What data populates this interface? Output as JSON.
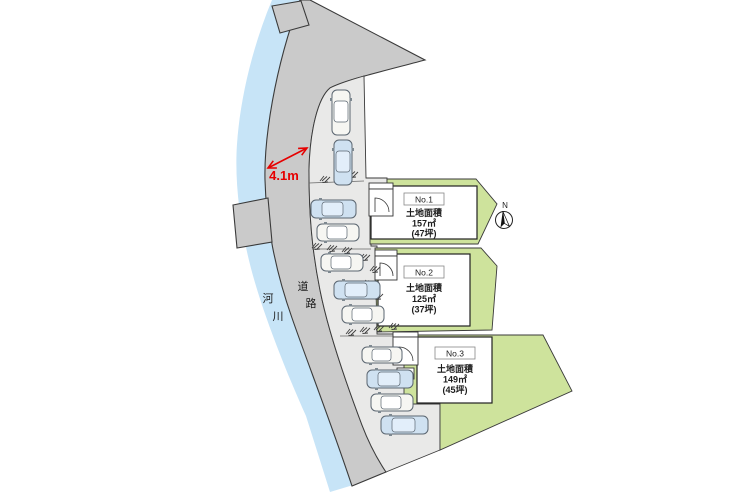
{
  "colors": {
    "river": "#c7e4f7",
    "road": "#cacaca",
    "driveway": "#e9e9e8",
    "lot_green": "#cee39c",
    "building": "#ffffff",
    "car_blue": "#cfe1f1",
    "car_white": "#f6f6f2",
    "accent_red": "#e60000",
    "ink": "#1c1c1c",
    "line": "#3a3a3a"
  },
  "labels": {
    "river_chars": [
      "河",
      "川"
    ],
    "road_chars": [
      "道",
      "路"
    ],
    "road_width": "4.1m",
    "north": "N"
  },
  "lots": [
    {
      "id": "No.1",
      "area_label": "土地面積",
      "area": "157㎡",
      "tsubo": "(47坪)"
    },
    {
      "id": "No.2",
      "area_label": "土地面積",
      "area": "125㎡",
      "tsubo": "(37坪)"
    },
    {
      "id": "No.3",
      "area_label": "土地面積",
      "area": "149㎡",
      "tsubo": "(45坪)"
    }
  ]
}
